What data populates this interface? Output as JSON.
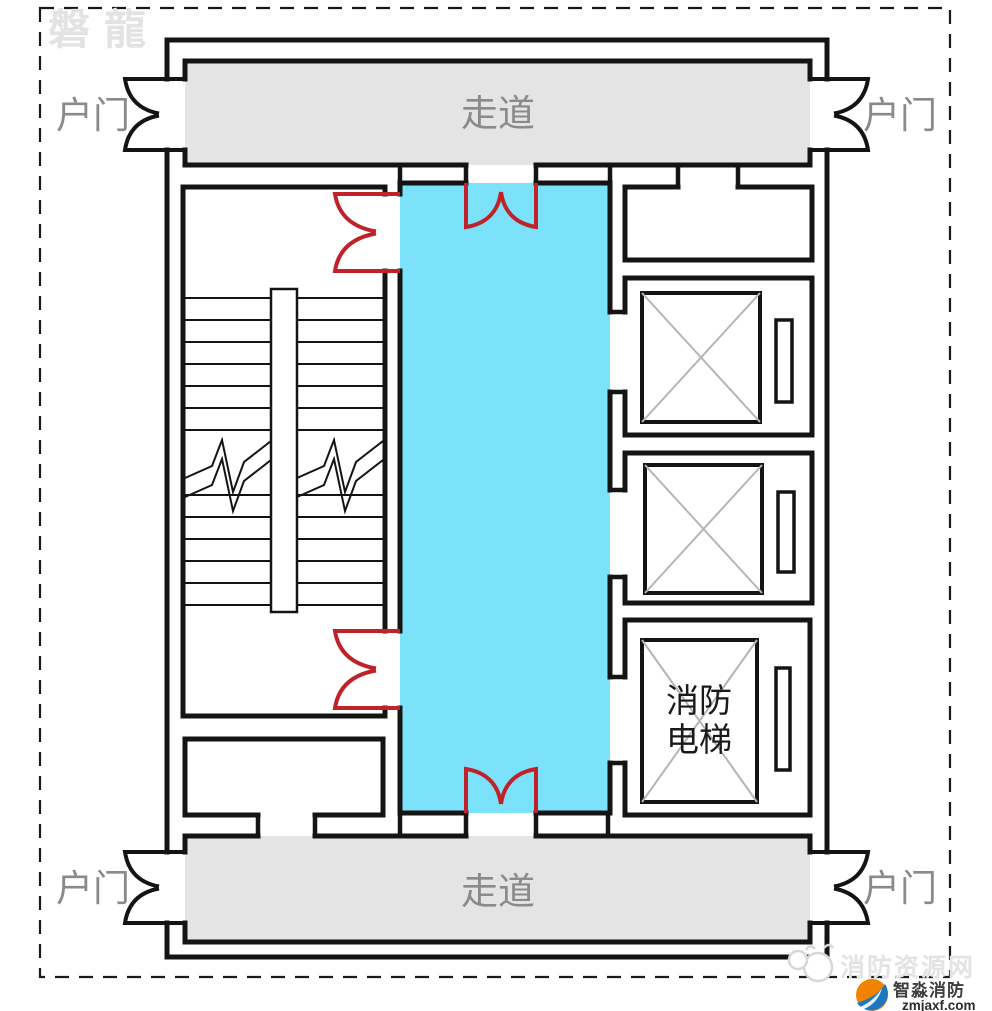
{
  "watermarks": {
    "top_left": "磐龍",
    "bottom_right_site": "消防资源网"
  },
  "plan": {
    "corridor_top": "走道",
    "corridor_bottom": "走道",
    "entry_top_left": "户门",
    "entry_top_right": "户门",
    "entry_bottom_left": "户门",
    "entry_bottom_right": "户门",
    "fire_elevator_line1": "消防",
    "fire_elevator_line2": "电梯"
  },
  "footer_logo": {
    "name": "智淼消防",
    "site": "zmjaxf.com"
  },
  "colors": {
    "lobby_fill": "#7CE2FB",
    "corridor_fill": "#E4E4E4",
    "fire_door_red": "#BF2228",
    "label_gray": "#8A8A8A",
    "watermark_gray": "#E3E3E3",
    "logo_orange": "#F08300",
    "logo_blue": "#1F77C2"
  }
}
